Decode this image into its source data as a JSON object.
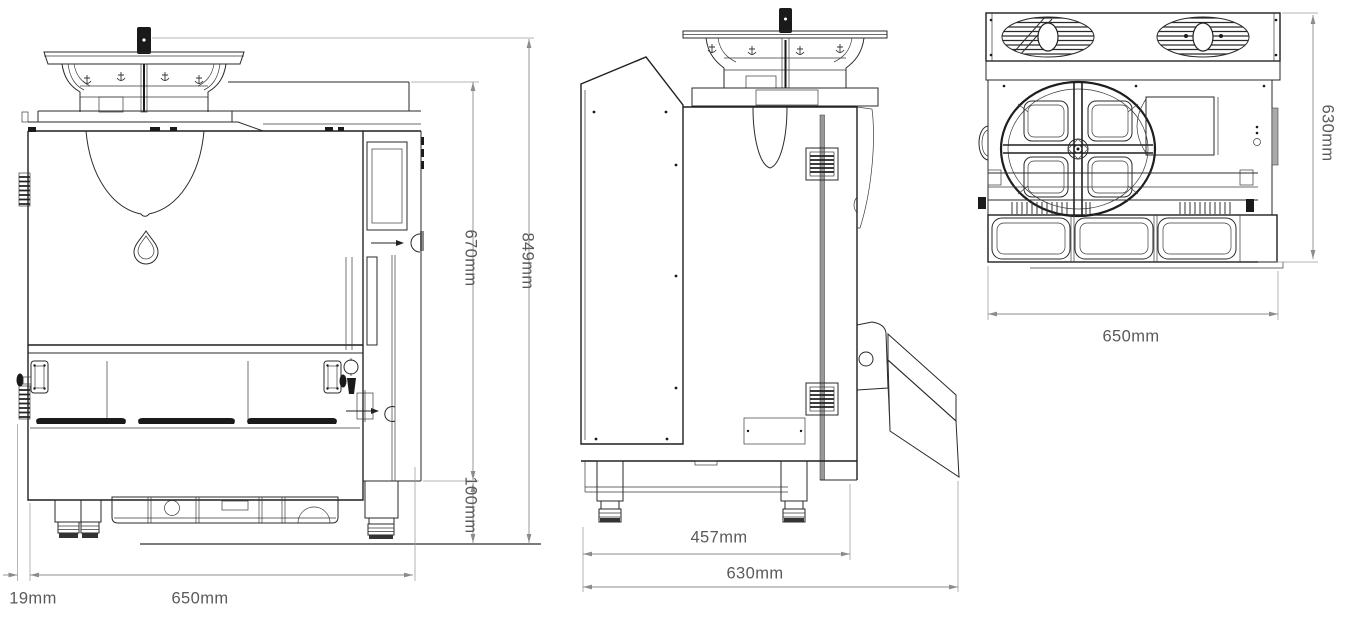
{
  "colors": {
    "background": "#ffffff",
    "line_art": "#1e1e1e",
    "dimension_line": "#8c8c8c",
    "dimension_text": "#5a5a5a"
  },
  "icons": {
    "logo": "droplet-icon",
    "top_view_fans": "fan-icon",
    "hopper_marks": "anchor-icon",
    "detail_pointer": "arrow-right-icon"
  },
  "views": {
    "front": {
      "dims": {
        "total_height": "849mm",
        "upper_height": "670mm",
        "leg_height": "100mm",
        "left_offset": "19mm",
        "width": "650mm"
      }
    },
    "side": {
      "dims": {
        "body_depth": "457mm",
        "total_depth": "630mm"
      }
    },
    "top": {
      "dims": {
        "depth": "630mm",
        "width": "650mm"
      }
    }
  }
}
